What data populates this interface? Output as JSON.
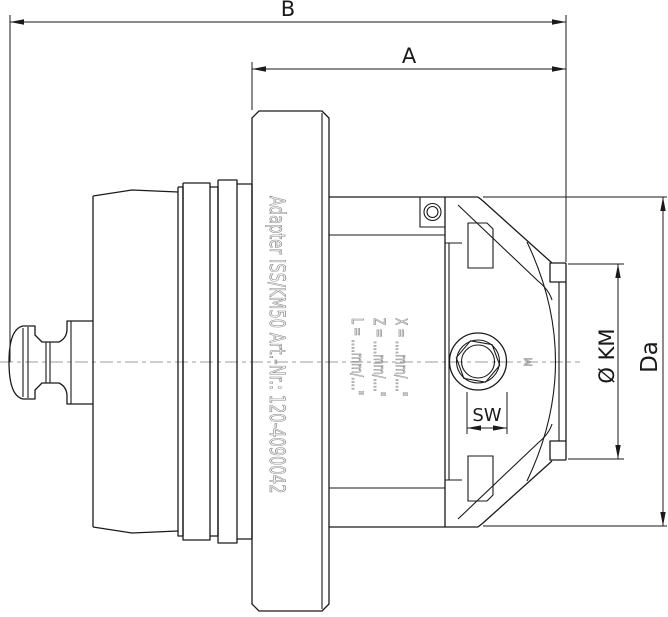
{
  "dimensions": {
    "overall_length_label": "B",
    "front_length_label": "A",
    "outer_diameter_label": "Da",
    "clamp_diameter_label": "Ø KM",
    "hex_width_label": "SW"
  },
  "engravings": {
    "flange_text": "Adapter ISS/KM50 Art.-Nr.: 120-4090042",
    "thread_marker": "M",
    "preset_rows": [
      "L = ....mm/....\"",
      "Z = ....mm/....\"",
      "X = ....mm/....\""
    ]
  },
  "colors": {
    "line": "#1a1a1a",
    "centerline": "#9e9e9e",
    "engraving": "#8a8a8a"
  }
}
